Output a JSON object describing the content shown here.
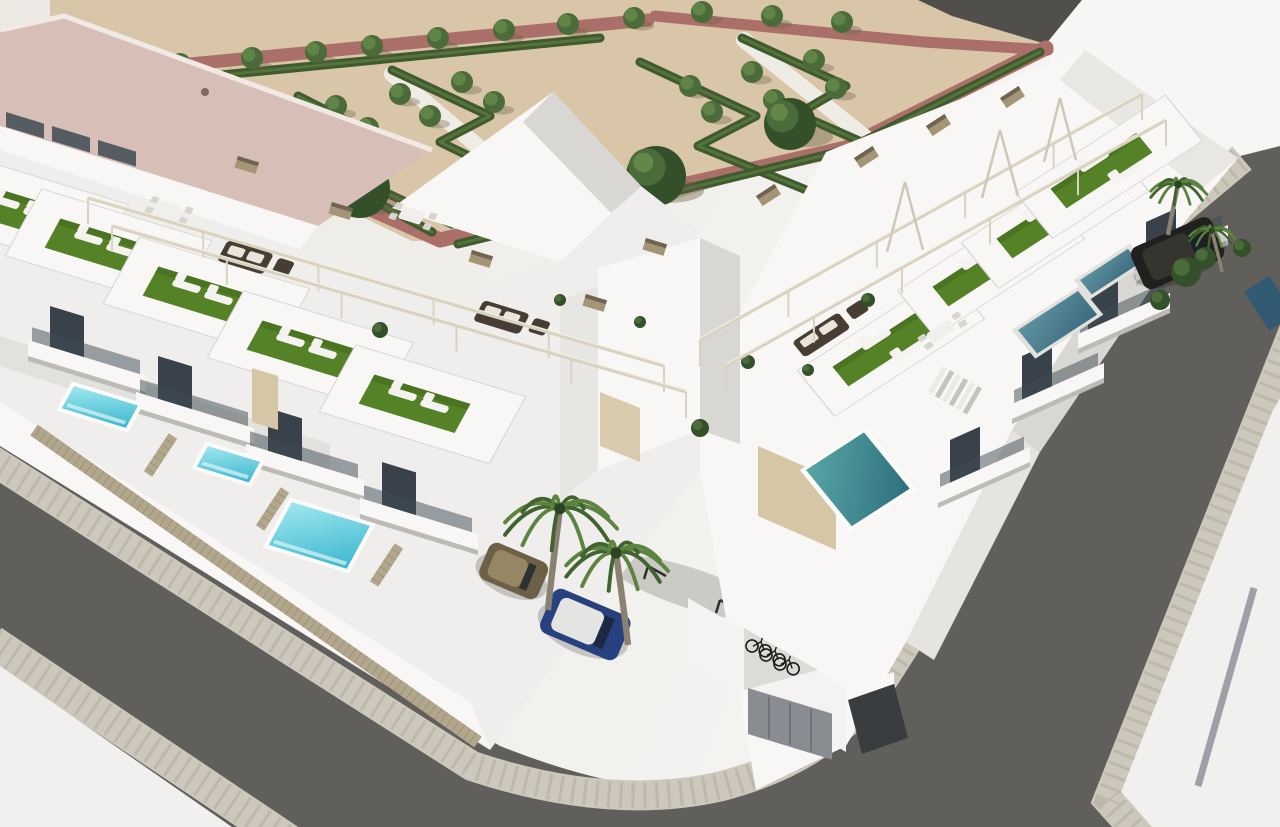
{
  "scene": {
    "type": "aerial-3d-architectural-rendering",
    "subject": "modern white townhouse development with rooftop terraces, private pools, landscaped park, corner streets, parked cars, palm trees and bicycle parking"
  },
  "colors": {
    "bg_left": "#ece9e3",
    "bg_right": "#f6f6f5",
    "sand": "#d9c6a8",
    "shadow": "#6b5f49",
    "road_top": "#504f4b",
    "path_red": "#ab6f6a",
    "hedge": "#3e5a2e",
    "hedge_light": "#5b7a3e",
    "tree": "#4c6b3a",
    "tree_light": "#648749",
    "tree_dark": "#33502a",
    "walkway": "#efece6",
    "roof_pink": "#d7bfb8",
    "roof_ridge": "#f0e9e4",
    "white_lit": "#f8f7f5",
    "white_mid": "#efeeec",
    "white_shade": "#d9d7d3",
    "white_dark": "#bdbbb6",
    "glass": "#3e4a52",
    "window_dark": "#39424a",
    "turf": "#558226",
    "turf_dark": "#3f641f",
    "asphalt": "#605f5b",
    "paver": "#cdc8bc",
    "paver_joint": "#b2ac9e",
    "white_ground": "#f1f0ee",
    "stripe_gray": "#a19ea7",
    "pool_bright_hi": "#9fe7ee",
    "pool_bright_lo": "#3cb7cf",
    "pool_teal_hi": "#57a5a4",
    "pool_teal_lo": "#2f6f7e",
    "pool_shaded_hi": "#5f93a0",
    "pool_shaded_lo": "#3a6a7e",
    "pool_dark": "#2e5a74",
    "coping": "#fbfbfa",
    "fence": "#b2a68c",
    "fence_dark": "#8f8469",
    "beam": "#d9d2c0",
    "beam_hi": "#f2eee4",
    "cap_tan": "#a39575",
    "cap_dark": "#6f6450",
    "wicker": "#473d33",
    "cushion": "#e9e5da",
    "lounger": "#f4f3f0",
    "table_white": "#f1efec",
    "chair_gray": "#d8d5cf",
    "palm_trunk": "#8a8173",
    "palm_green": "#41632f",
    "palm_green_light": "#5c8340",
    "car_blue": "#26417d",
    "car_blue_roof": "#e4e4e2",
    "car_brown": "#6e6046",
    "car_brown_roof": "#958664",
    "suv_dark": "#21201e",
    "suv_roof": "#35342f",
    "door_gray": "#898d92",
    "ramp_dark": "#3a3d40",
    "beige_panel": "#d5c7a6",
    "bike_dark": "#1b1b19"
  },
  "park": {
    "small_trees": [
      [
        180,
        64
      ],
      [
        252,
        58
      ],
      [
        316,
        52
      ],
      [
        372,
        46
      ],
      [
        438,
        38
      ],
      [
        504,
        30
      ],
      [
        568,
        24
      ],
      [
        634,
        18
      ],
      [
        702,
        12
      ],
      [
        772,
        16
      ],
      [
        842,
        22
      ],
      [
        336,
        106
      ],
      [
        400,
        94
      ],
      [
        462,
        82
      ],
      [
        368,
        128
      ],
      [
        430,
        116
      ],
      [
        494,
        102
      ],
      [
        690,
        86
      ],
      [
        752,
        72
      ],
      [
        814,
        60
      ],
      [
        712,
        112
      ],
      [
        774,
        100
      ],
      [
        836,
        88
      ]
    ],
    "large_trees": [
      [
        360,
        188,
        30
      ],
      [
        656,
        176,
        30
      ],
      [
        790,
        124,
        26
      ]
    ],
    "hedges": [
      "298,96 388,142 334,168 452,224",
      "452,224 530,186 440,142 490,116 392,70",
      "640,62 756,116 698,146 826,198",
      "826,198 898,158 798,114 846,86 742,38",
      "262,140 432,232",
      "458,244 846,150",
      "846,150 1040,52",
      "170,80 600,38"
    ],
    "red_paths": [
      {
        "pts": "148,68 648,20",
        "w": 13
      },
      {
        "pts": "238,150 440,240 846,148 1046,48",
        "w": 15
      },
      {
        "pts": "655,16 924,42 1048,50",
        "w": 11
      }
    ],
    "white_walkways": [
      "392,74 530,190",
      "744,40 896,162"
    ]
  },
  "buildings": {
    "left_row_units": [
      [
        15,
        210
      ],
      [
        98,
        246
      ],
      [
        196,
        294
      ],
      [
        300,
        348
      ],
      [
        412,
        402
      ]
    ],
    "right_row_units": [
      [
        886,
        348
      ],
      [
        986,
        268
      ],
      [
        1050,
        220
      ],
      [
        1104,
        170
      ]
    ],
    "left_windows": [
      [
        50,
        306
      ],
      [
        158,
        356
      ],
      [
        268,
        408
      ],
      [
        382,
        462
      ]
    ],
    "left_balconies": [
      [
        28,
        340
      ],
      [
        136,
        392
      ],
      [
        246,
        444
      ],
      [
        360,
        498
      ]
    ],
    "roof_windows_big_building": [
      [
        6,
        112
      ],
      [
        52,
        126
      ],
      [
        98,
        140
      ]
    ],
    "right_windows": [
      [
        950,
        440
      ],
      [
        1022,
        356
      ],
      [
        1088,
        286
      ],
      [
        1146,
        222
      ]
    ],
    "right_balconies": [
      [
        938,
        488
      ],
      [
        1012,
        404
      ],
      [
        1078,
        334
      ],
      [
        1136,
        266
      ]
    ],
    "beige_panel": [
      252,
      368
    ],
    "garage_door": "758,446 836,480 836,550 758,516",
    "small_door": "600,392 640,408 640,462 600,446"
  },
  "amenities": {
    "pools_sunlit": [
      [
        74,
        386,
        64,
        26
      ],
      [
        208,
        446,
        52,
        24
      ],
      [
        292,
        502,
        78,
        50
      ]
    ],
    "pool_corner_teal": [
      806,
      470,
      58,
      86
    ],
    "pools_shaded": [
      [
        1018,
        330,
        60,
        36
      ],
      [
        1080,
        280,
        48,
        22
      ]
    ],
    "pool_sliver_right": [
      1244,
      292,
      30,
      46
    ],
    "sofa_sets": [
      [
        228,
        240,
        "L"
      ],
      [
        484,
        300,
        "L"
      ],
      [
        792,
        342,
        "R"
      ]
    ],
    "dining_tables": [
      [
        160,
        200,
        "L"
      ],
      [
        404,
        206,
        "L"
      ],
      [
        926,
        334,
        "R"
      ]
    ],
    "roof_plants": [
      [
        380,
        330,
        8
      ],
      [
        700,
        428,
        9
      ],
      [
        748,
        362,
        7
      ],
      [
        560,
        300,
        6
      ],
      [
        640,
        322,
        6
      ],
      [
        868,
        300,
        7
      ],
      [
        808,
        370,
        6
      ]
    ],
    "stairs": [
      928,
      392
    ]
  },
  "pergolas": {
    "beams": [
      [
        88,
        198,
        664,
        366
      ],
      [
        112,
        226,
        686,
        392
      ],
      [
        700,
        340,
        1142,
        94
      ],
      [
        726,
        366,
        1166,
        120
      ]
    ],
    "a_frames": [
      [
        905,
        182,
        887,
        252,
        923,
        250
      ],
      [
        1000,
        130,
        982,
        198,
        1018,
        196
      ],
      [
        1060,
        98,
        1044,
        162,
        1076,
        160
      ]
    ],
    "caps": [
      [
        332,
        202,
        17
      ],
      [
        472,
        250,
        17
      ],
      [
        586,
        294,
        17
      ],
      [
        238,
        156,
        17
      ],
      [
        646,
        238,
        17
      ],
      [
        756,
        196,
        -33
      ],
      [
        854,
        158,
        -33
      ],
      [
        926,
        126,
        -33
      ],
      [
        1000,
        98,
        -33
      ]
    ]
  },
  "vehicles": {
    "brown_car": {
      "x": 492,
      "y": 540,
      "rot": 23
    },
    "blue_car": {
      "x": 556,
      "y": 586,
      "rot": 23
    },
    "dark_suv": {
      "x": 1128,
      "y": 250,
      "rot": -24
    },
    "bicycles": [
      [
        752,
        646
      ],
      [
        766,
        655
      ],
      [
        780,
        664
      ]
    ],
    "parking_marks": [
      [
        648,
        566
      ],
      [
        720,
        600
      ],
      [
        792,
        634
      ]
    ]
  },
  "vegetation": {
    "palms": [
      {
        "x": 548,
        "y": 610,
        "s": 2.2,
        "lean": 0.35
      },
      {
        "x": 628,
        "y": 645,
        "s": 2.0,
        "lean": -0.35
      },
      {
        "x": 1168,
        "y": 235,
        "s": 1.1,
        "lean": 0.3
      },
      {
        "x": 1222,
        "y": 272,
        "s": 0.9,
        "lean": -0.3
      }
    ],
    "bushes": [
      [
        1186,
        272,
        15
      ],
      [
        1205,
        258,
        11
      ],
      [
        1160,
        300,
        10
      ],
      [
        1242,
        248,
        9
      ]
    ]
  },
  "counts": {
    "townhouse_units_visible": 9,
    "sunlit_pools": 3,
    "shaded_pools": 4,
    "cars": 3,
    "bicycles": 3,
    "palm_trees": 4,
    "park_small_trees": 23,
    "park_large_trees": 3
  }
}
